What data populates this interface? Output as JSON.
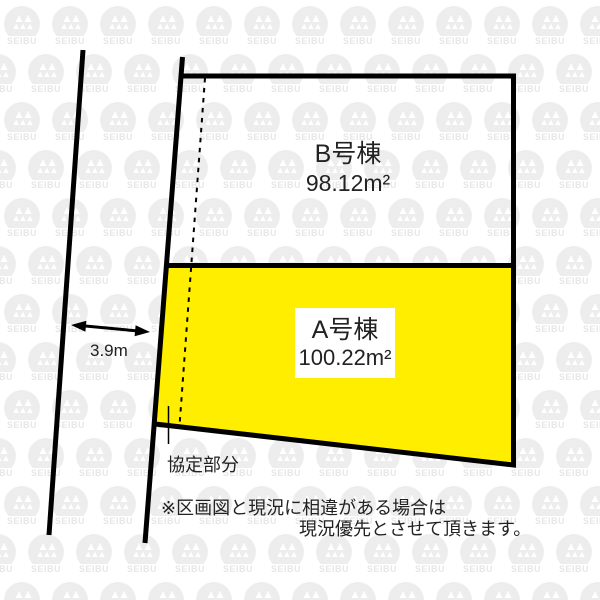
{
  "watermark": {
    "brand": "SEIBU"
  },
  "plots": {
    "b": {
      "name": "B号棟",
      "area": "98.12m²"
    },
    "a": {
      "name": "A号棟",
      "area": "100.22m²"
    }
  },
  "labels": {
    "road_width": "3.9m",
    "agreement": "協定部分",
    "note_line1": "※区画図と現況に相違がある場合は",
    "note_line2": "現況優先とさせて頂きます。"
  },
  "colors": {
    "plot_a_fill": "#ffee00",
    "line": "#000000",
    "text": "#222222",
    "watermark_gray": "#ebebeb"
  }
}
